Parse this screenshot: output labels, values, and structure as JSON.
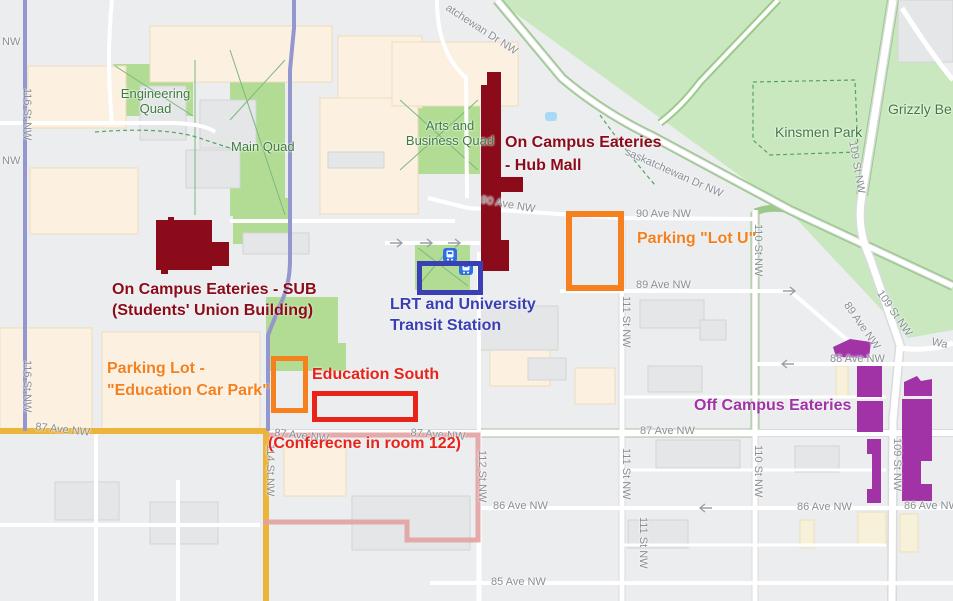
{
  "colors": {
    "highlight_dark_red": "#8b0b1a",
    "annotation_orange": "#f5801d",
    "annotation_red": "#e8231a",
    "annotation_blue": "#3a40b4",
    "annotation_purple": "#a133a7",
    "road_purple": "#9497ce",
    "road_yellow": "#edb43c",
    "route_pink": "#e2a1a1",
    "transit_icon_blue": "#2e6fe8",
    "park_green": "#c9e8c0",
    "quad_green": "#b2dc94"
  },
  "map": {
    "area_labels": {
      "engineering_quad": "Engineering Quad",
      "main_quad": "Main Quad",
      "arts_quad": "Arts and Business Quad",
      "kinsmen_park": "Kinsmen Park",
      "grizzly": "Grizzly Be"
    },
    "street_labels": {
      "nw_a": "NW",
      "nw_b": "NW",
      "st116_a": "116 St NW",
      "st116_b": "116 St NW",
      "st114": "114 St NW",
      "st112": "112 St NW",
      "st111_a": "111 St NW",
      "st111_b": "111 St NW",
      "st111_c": "111 St NW",
      "st110_a": "110 St NW",
      "st110_b": "110 St NW",
      "st109_a": "109 St NW",
      "st109_b": "109 St NW",
      "st109_c": "109 St NW",
      "sask_a": "atchewan Dr NW",
      "sask_b": "saskatchewan Dr NW",
      "ave90_a": "90 Ave NW",
      "ave90_b": "90 Ave NW",
      "ave89_a": "89 Ave NW",
      "ave89_b": "89 Ave NW",
      "ave88": "88 Ave NW",
      "ave87_a": "87 Ave NW",
      "ave87_b": "87 Ave NW",
      "ave87_c": "87 Ave NW",
      "ave87_d": "87 Ave NW",
      "ave86_a": "86 Ave NW",
      "ave86_b": "86 Ave NW",
      "ave86_c": "86 Ave NW",
      "ave85": "85 Ave NW",
      "wa": "Wa"
    }
  },
  "annotations": {
    "hub": {
      "line1": "On Campus Eateries",
      "line2": "- Hub Mall"
    },
    "sub": {
      "line1": "On Campus Eateries - SUB",
      "line2": "(Students' Union Building)"
    },
    "lrt": {
      "line1": "LRT and University",
      "line2": "Transit Station"
    },
    "lot_u": {
      "text": "Parking \"Lot U\""
    },
    "edu_park": {
      "line1": "Parking Lot -",
      "line2": "\"Education Car Park\""
    },
    "edu_south": {
      "text": "Education South"
    },
    "conference": {
      "text": "(Conferecne in room 122)"
    },
    "off_campus": {
      "text": "Off Campus Eateries"
    }
  }
}
